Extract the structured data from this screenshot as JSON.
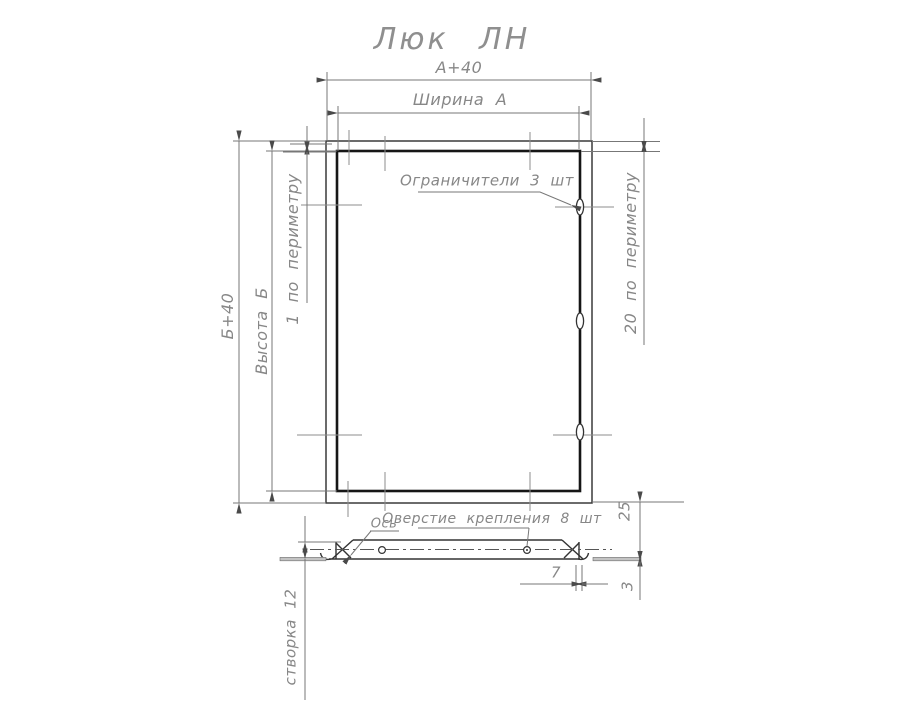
{
  "title": "Люк ЛН",
  "colors": {
    "background": "#ffffff",
    "line_dark": "#161616",
    "line_medium": "#3a3a3a",
    "line_thin": "#777777",
    "text_gray": "#878787"
  },
  "main_view": {
    "dim_outer_width": "А+40",
    "dim_inner_width": "Ширина А",
    "dim_outer_height": "Б+40",
    "dim_inner_height": "Высота Б",
    "dim_gap_perimeter": "1  по  периметру",
    "dim_flange_perimeter": "20  по  периметру",
    "limiters_label": "Ограничители 3 шт",
    "limiters_count": 3
  },
  "section_view": {
    "axis_label": "Ось",
    "mount_holes_label": "Оверстие крепления 8 шт",
    "mount_holes_count": 8,
    "dim_frame_depth": "25",
    "dim_hinge_offset": "7",
    "dim_sheet_thickness": "3",
    "dim_leaf": "створка 12"
  }
}
